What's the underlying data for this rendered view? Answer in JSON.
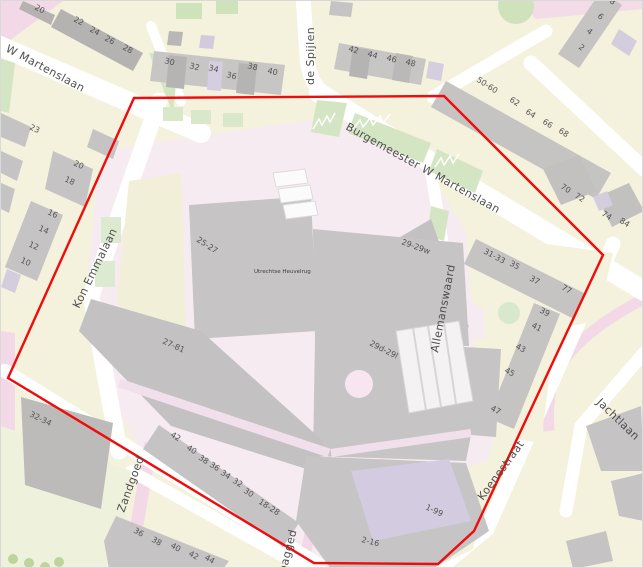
{
  "map": {
    "boundary": {
      "color": "#ee0c0c",
      "points": "133,97 443,95 602,254 473,530 437,563 313,562 7,377"
    },
    "colors": {
      "landuse_yellow": "#f4f1dc",
      "campus_pink": "#f7ebf2",
      "road_pink": "#f3d9e7",
      "road_white": "#ffffff",
      "building_gray": "#c6c3c4",
      "building_dark": "#b2afaf",
      "building_lavender": "#d5cee0",
      "green": "#d4e5c3"
    },
    "street_labels": [
      {
        "t": "W Martenslaan",
        "x": 4,
        "y": 50,
        "r": 28
      },
      {
        "t": "de Spijlen",
        "x": 313,
        "y": 84,
        "r": -90
      },
      {
        "t": "Burgemeester W Martenslaan",
        "x": 344,
        "y": 128,
        "r": 29
      },
      {
        "t": "Kon Emmalaan",
        "x": 78,
        "y": 308,
        "r": -64
      },
      {
        "t": "Allemanswaard",
        "x": 437,
        "y": 352,
        "r": -79
      },
      {
        "t": "Jachtlaan",
        "x": 595,
        "y": 402,
        "r": 44
      },
      {
        "t": "Koenestraat",
        "x": 482,
        "y": 500,
        "r": -54
      },
      {
        "t": "Zandgoed",
        "x": 123,
        "y": 512,
        "r": -70,
        "s": 10
      },
      {
        "t": "pagged",
        "x": 285,
        "y": 572,
        "r": -76,
        "s": 10
      }
    ],
    "place_labels": [
      {
        "t": "Utrechtse Heuvelrug",
        "x": 253,
        "y": 272,
        "r": 0
      }
    ],
    "house_numbers": [
      {
        "t": "20",
        "x": 33,
        "y": 8,
        "r": 28
      },
      {
        "t": "22",
        "x": 72,
        "y": 20,
        "r": 28
      },
      {
        "t": "24",
        "x": 88,
        "y": 30,
        "r": 28
      },
      {
        "t": "26",
        "x": 103,
        "y": 39,
        "r": 28
      },
      {
        "t": "28",
        "x": 121,
        "y": 48,
        "r": 28
      },
      {
        "t": "23",
        "x": 28,
        "y": 128,
        "r": 25
      },
      {
        "t": "30",
        "x": 163,
        "y": 62,
        "r": 14
      },
      {
        "t": "32",
        "x": 188,
        "y": 67,
        "r": 14
      },
      {
        "t": "34",
        "x": 207,
        "y": 69,
        "r": 14
      },
      {
        "t": "36",
        "x": 225,
        "y": 76,
        "r": 14
      },
      {
        "t": "38",
        "x": 246,
        "y": 67,
        "r": 14
      },
      {
        "t": "40",
        "x": 266,
        "y": 72,
        "r": 14
      },
      {
        "t": "42",
        "x": 347,
        "y": 50,
        "r": 16
      },
      {
        "t": "44",
        "x": 366,
        "y": 55,
        "r": 16
      },
      {
        "t": "46",
        "x": 385,
        "y": 59,
        "r": 16
      },
      {
        "t": "48",
        "x": 404,
        "y": 63,
        "r": 16
      },
      {
        "t": "50-60",
        "x": 475,
        "y": 80,
        "r": 33
      },
      {
        "t": "62",
        "x": 508,
        "y": 100,
        "r": 33
      },
      {
        "t": "64",
        "x": 524,
        "y": 112,
        "r": 33
      },
      {
        "t": "66",
        "x": 541,
        "y": 122,
        "r": 33
      },
      {
        "t": "68",
        "x": 557,
        "y": 131,
        "r": 33
      },
      {
        "t": "8",
        "x": 608,
        "y": 1,
        "r": 38
      },
      {
        "t": "6",
        "x": 596,
        "y": 16,
        "r": 38
      },
      {
        "t": "4",
        "x": 585,
        "y": 31,
        "r": 38
      },
      {
        "t": "2",
        "x": 577,
        "y": 47,
        "r": 38
      },
      {
        "t": "70",
        "x": 559,
        "y": 187,
        "r": 32
      },
      {
        "t": "72",
        "x": 573,
        "y": 196,
        "r": 32
      },
      {
        "t": "74",
        "x": 600,
        "y": 214,
        "r": 32
      },
      {
        "t": "84",
        "x": 618,
        "y": 221,
        "r": 32
      },
      {
        "t": "20",
        "x": 72,
        "y": 164,
        "r": 25
      },
      {
        "t": "18",
        "x": 63,
        "y": 180,
        "r": 25
      },
      {
        "t": "16",
        "x": 46,
        "y": 213,
        "r": 25
      },
      {
        "t": "14",
        "x": 37,
        "y": 229,
        "r": 25
      },
      {
        "t": "12",
        "x": 27,
        "y": 245,
        "r": 25
      },
      {
        "t": "10",
        "x": 19,
        "y": 261,
        "r": 25
      },
      {
        "t": "25-27",
        "x": 195,
        "y": 240,
        "r": 33
      },
      {
        "t": "29-29w",
        "x": 400,
        "y": 243,
        "r": 20
      },
      {
        "t": "31-33",
        "x": 482,
        "y": 252,
        "r": 28
      },
      {
        "t": "35",
        "x": 508,
        "y": 264,
        "r": 28
      },
      {
        "t": "37",
        "x": 528,
        "y": 279,
        "r": 28
      },
      {
        "t": "77",
        "x": 560,
        "y": 288,
        "r": 30
      },
      {
        "t": "39",
        "x": 538,
        "y": 311,
        "r": 28
      },
      {
        "t": "41",
        "x": 530,
        "y": 326,
        "r": 28
      },
      {
        "t": "43",
        "x": 514,
        "y": 347,
        "r": 28
      },
      {
        "t": "45",
        "x": 503,
        "y": 371,
        "r": 28
      },
      {
        "t": "47",
        "x": 489,
        "y": 409,
        "r": 28
      },
      {
        "t": "27-81",
        "x": 161,
        "y": 342,
        "r": 25
      },
      {
        "t": "29d-29l",
        "x": 368,
        "y": 344,
        "r": 27
      },
      {
        "t": "32-34",
        "x": 28,
        "y": 415,
        "r": 26
      },
      {
        "t": "42",
        "x": 169,
        "y": 435,
        "r": 33
      },
      {
        "t": "40",
        "x": 185,
        "y": 448,
        "r": 33
      },
      {
        "t": "38",
        "x": 197,
        "y": 458,
        "r": 33
      },
      {
        "t": "36",
        "x": 208,
        "y": 465,
        "r": 33
      },
      {
        "t": "34",
        "x": 219,
        "y": 473,
        "r": 33
      },
      {
        "t": "32",
        "x": 231,
        "y": 481,
        "r": 33
      },
      {
        "t": "30",
        "x": 242,
        "y": 491,
        "r": 33
      },
      {
        "t": "18-28",
        "x": 257,
        "y": 502,
        "r": 33
      },
      {
        "t": "36",
        "x": 132,
        "y": 531,
        "r": 30
      },
      {
        "t": "38",
        "x": 150,
        "y": 540,
        "r": 30
      },
      {
        "t": "40",
        "x": 169,
        "y": 546,
        "r": 30
      },
      {
        "t": "42",
        "x": 187,
        "y": 554,
        "r": 30
      },
      {
        "t": "44",
        "x": 203,
        "y": 558,
        "r": 30
      },
      {
        "t": "1-99",
        "x": 424,
        "y": 508,
        "r": 25
      },
      {
        "t": "2-16",
        "x": 360,
        "y": 541,
        "r": 14
      }
    ]
  }
}
